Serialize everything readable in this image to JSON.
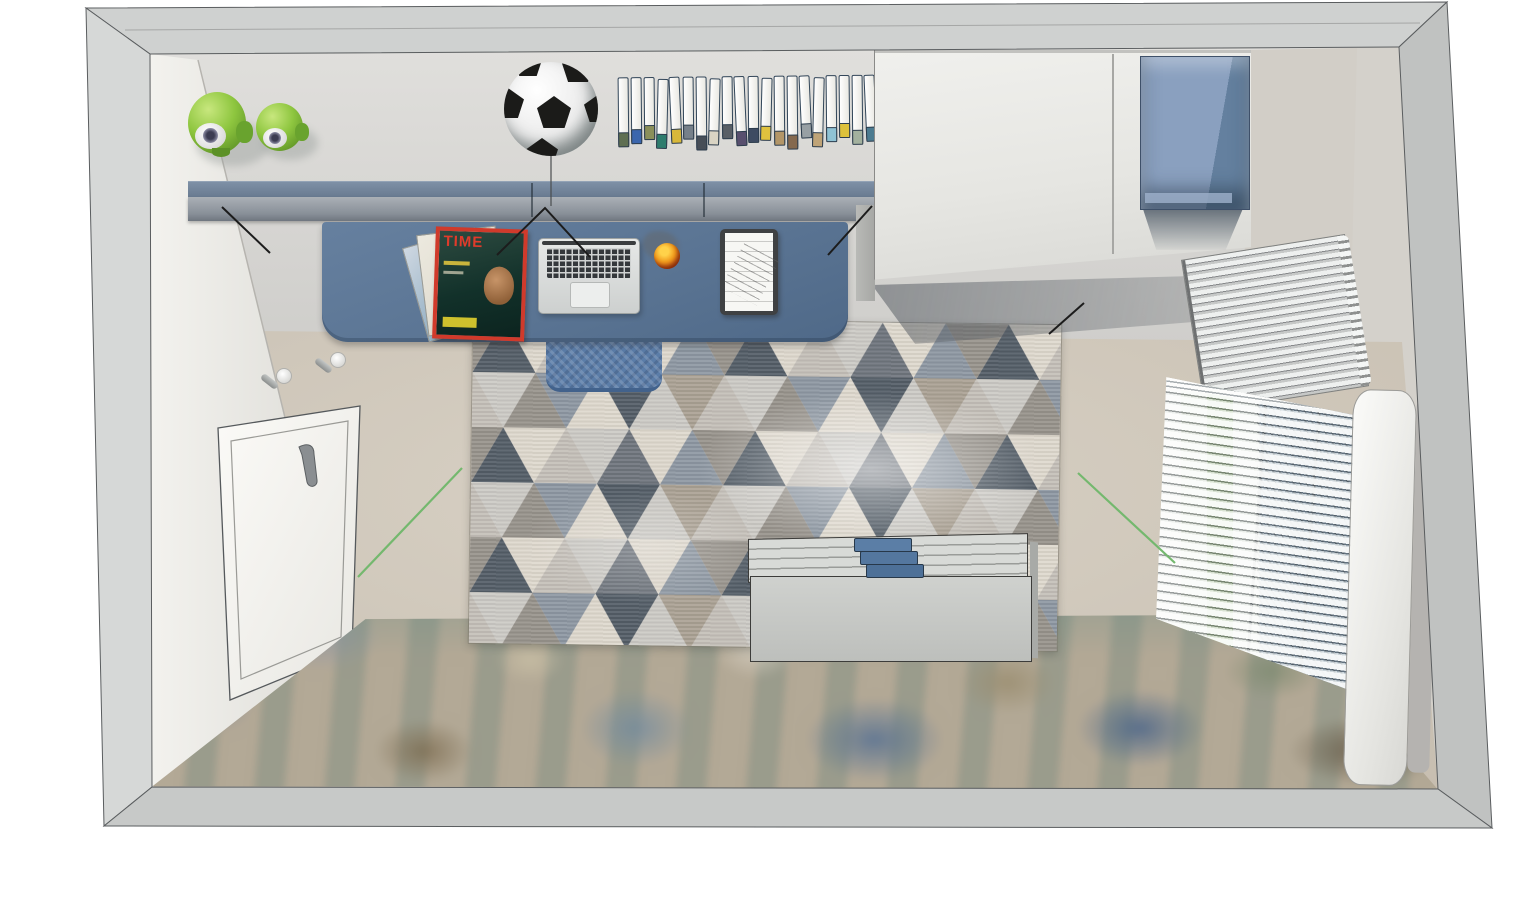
{
  "meta": {
    "title": "Kids room — top-down 3D interior render",
    "view": "bird's-eye cutaway with wall thickness frame",
    "canvas": {
      "width": 1536,
      "height": 917
    }
  },
  "palette": {
    "frame_grey": "#cfd1d0",
    "wall_light": "#dcdbd8",
    "left_wall_white": "#efeeea",
    "floor_beige": "#cdc5b8",
    "desk_blue": "#5a7493",
    "shelf_blue": "#72849c",
    "chair_blue": "#5b7da8",
    "wardrobe_white": "#ebedea",
    "box_blue": "#7e96b6",
    "alien_green": "#8ec63f",
    "bench_grey": "#c6c8c5",
    "book_stack_blue": "#5b7ea6",
    "annotation_black": "#1c1c1c",
    "annotation_green": "#74b86e",
    "soccer_white": "#ffffff",
    "soccer_black": "#1b1b19",
    "magazine_red": "#d03a2b"
  },
  "desk": {
    "magazine_title": "TIME",
    "items": [
      "magazine-stack",
      "laptop",
      "orange-ball",
      "clipboard"
    ]
  },
  "books": {
    "count": 20,
    "colors": [
      "#5f6f52",
      "#3b66ad",
      "#8a8f5a",
      "#2e7c6d",
      "#d8b83a",
      "#76808a",
      "#474e57",
      "#d9d4c4",
      "#595f66",
      "#584f6e",
      "#3e4b62",
      "#e0c23e",
      "#b39668",
      "#85694e",
      "#98a0a4",
      "#bfa478",
      "#8fc2d4",
      "#ddc13b",
      "#a3b19e",
      "#4c7b90"
    ]
  },
  "bench": {
    "books_on_top": 3,
    "book_colors": [
      "#5b7ea6",
      "#54779f",
      "#4d7098"
    ]
  },
  "rug": {
    "style": "triangle tessellation",
    "palette": [
      "#ded8cd",
      "#c4bfb8",
      "#97928b",
      "#525c66",
      "#8d97a2",
      "#cccac5",
      "#6e747c",
      "#aaa193"
    ]
  },
  "scene_objects": [
    "alien-toys",
    "soccer-ball",
    "shelf-books",
    "wall-shelf",
    "desk",
    "desk-chair",
    "wardrobe",
    "wall-box",
    "radiator",
    "window-blinds",
    "curtain-panel",
    "door",
    "wall-hooks",
    "triangle-rug",
    "storage-bench",
    "bench-books",
    "mural-floor",
    "annotation-lines"
  ]
}
